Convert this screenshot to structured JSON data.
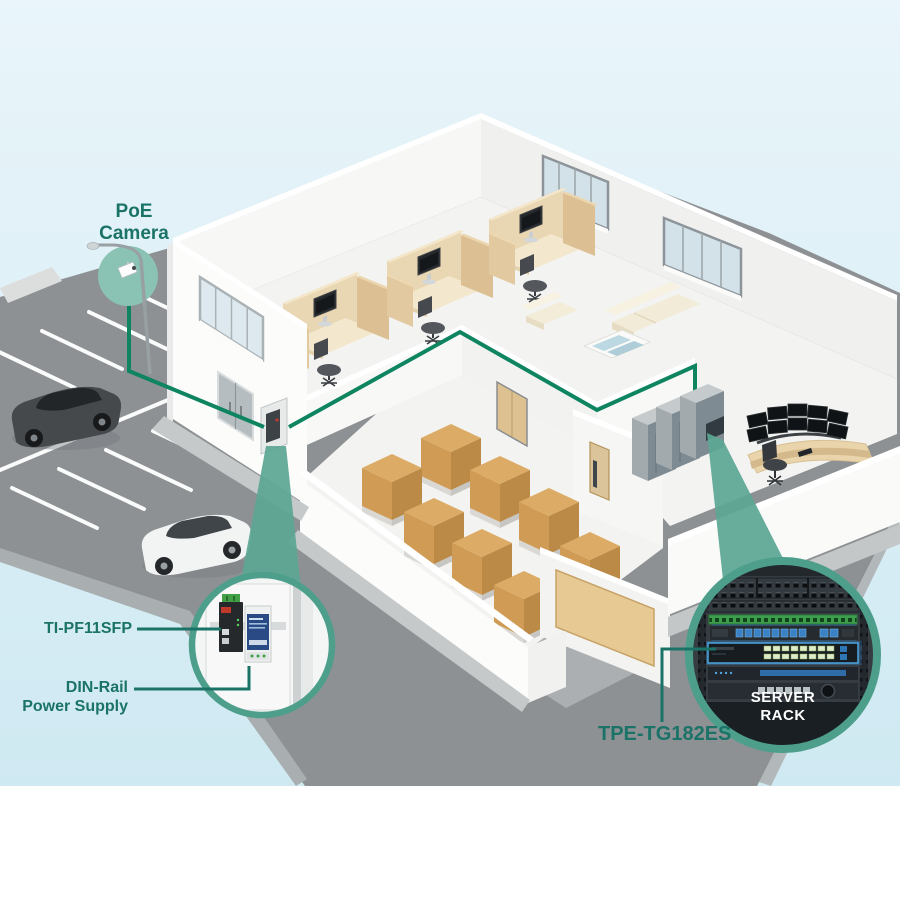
{
  "labels": {
    "poe_camera": {
      "line1": "PoE",
      "line2": "Camera"
    },
    "ti_pf11sfp": "TI-PF11SFP",
    "din_rail_power_supply": {
      "line1": "DIN-Rail",
      "line2": "Power Supply"
    },
    "tpe_tg182es": "TPE-TG182ES",
    "server_rack": {
      "line1": "SERVER",
      "line2": "RACK"
    }
  },
  "colors": {
    "label_text": "#1a7366",
    "server_rack_label_text": "#ffffff",
    "network_line": "#0e8560",
    "callout_ring": "#4d9f8c",
    "callout_wedge": "#5ca795",
    "camera_highlight": "#8ac2b4",
    "sky_top": "#e9f5fa",
    "sky_bottom": "#cfe9f2",
    "pavement": "#8e9194"
  }
}
